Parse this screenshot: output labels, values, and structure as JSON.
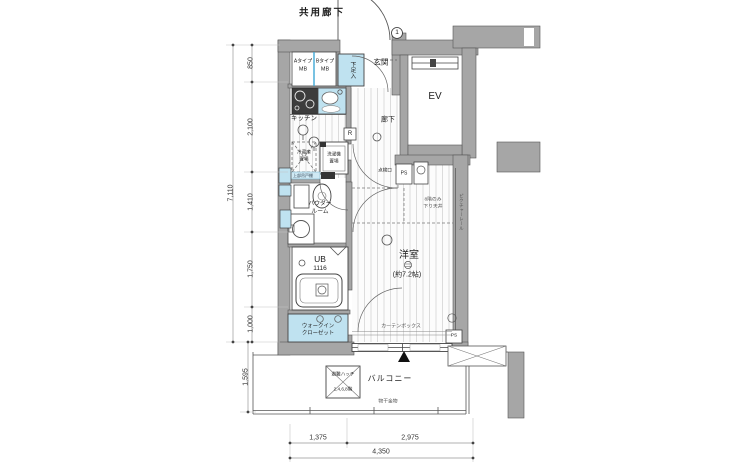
{
  "title": "共用廊下",
  "rooms": {
    "entrance": "玄関",
    "ev": "EV",
    "kitchen": "キッチン",
    "hallway": "廊下",
    "powder_line1": "パウダー",
    "powder_line2": "ルーム",
    "ub": "UB",
    "ub_size": "1116",
    "western_room": "洋室",
    "western_room_size": "(約7.2帖)",
    "wic_line1": "ウォークイン",
    "wic_line2": "クローゼット",
    "balcony": "バルコニー"
  },
  "features": {
    "mb_a_line1": "Aタイプ",
    "mb_a_line2": "MB",
    "mb_b_line1": "Bタイプ",
    "mb_b_line2": "MB",
    "shoe_box": "下足入",
    "fridge_line1": "冷蔵庫",
    "fridge_line2": "置場",
    "washer_line1": "洗濯機",
    "washer_line2": "置場",
    "upper_cabinet": "上部吊戸棚",
    "range_hood": "R",
    "inspection_port": "点検口",
    "ps_top": "PS",
    "ps_bottom": "PS",
    "lowered_ceiling_line1": "8階のみ",
    "lowered_ceiling_line2": "下り天井",
    "picture_rail": "ピクチャーレール",
    "curtain_box": "カーテンボックス",
    "escape_hatch_line1": "避難ハッチ",
    "escape_hatch_line2": "2,4,6,8階",
    "laundry_bracket": "物干金物",
    "door_number": "1"
  },
  "dimensions": {
    "left_total": "7,110",
    "left_segments": [
      "850",
      "2,100",
      "1,410",
      "1,750",
      "1,000"
    ],
    "balcony_depth": "1,595",
    "bottom_segments": [
      "1,375",
      "2,975"
    ],
    "bottom_total": "4,350"
  },
  "colors": {
    "wall": "#a6a6a6",
    "fixture_blue": "#bfe2f0",
    "mb_divider": "#3fa9d6",
    "line": "#3a3a3a"
  }
}
